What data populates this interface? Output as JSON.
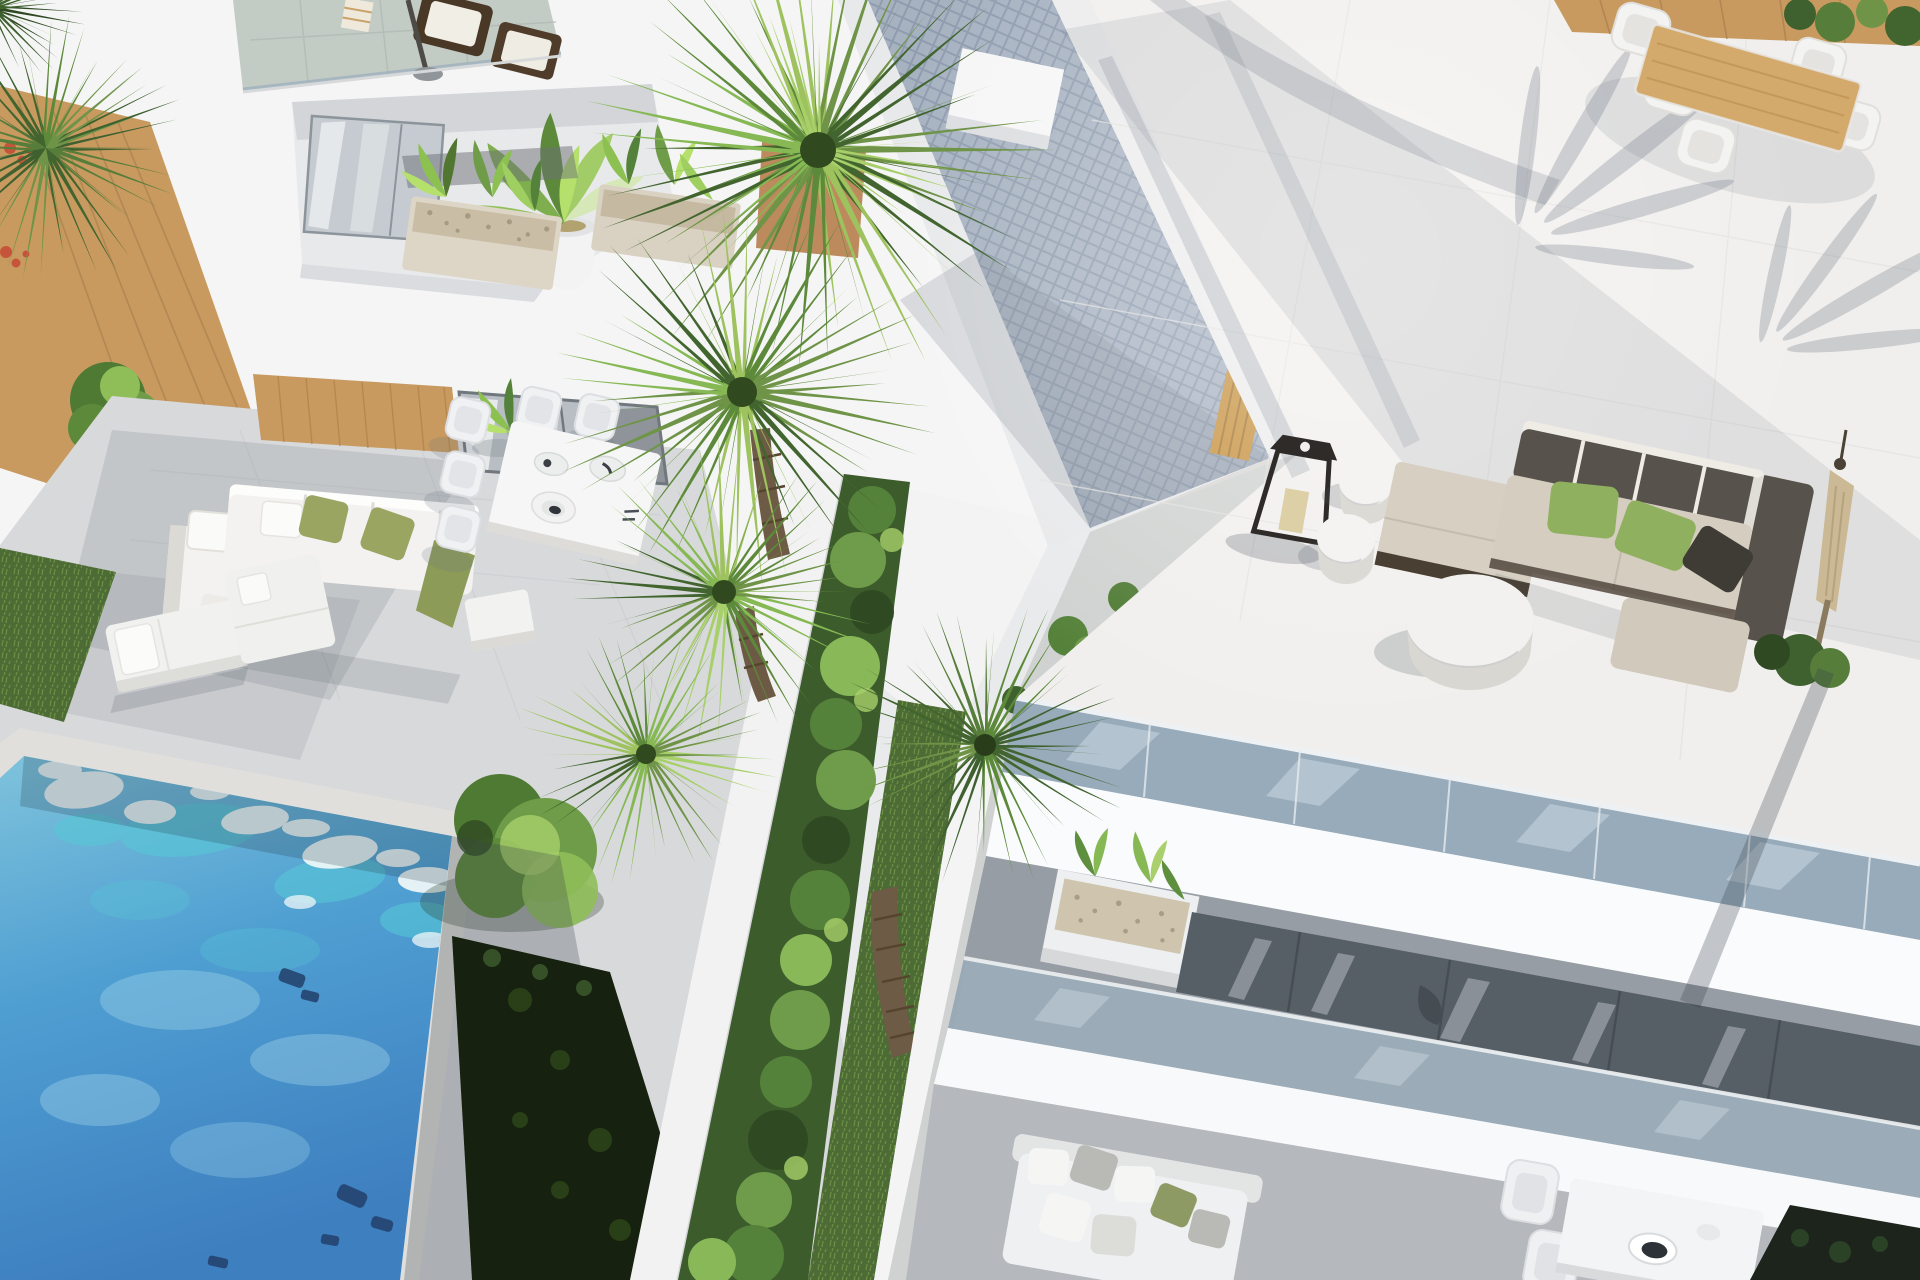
{
  "scene": {
    "title": "Aerial 3D architectural render of modern white villas with private pool, palm trees and roof terraces",
    "description": "Top-down rendering. Left: white villa with rooftop lounge, plant balconies, timber deck, garden patio with white corner sofa, dining set, sun loungers and a turquoise swimming pool. Center: fan palms over a hedge strip and a mosaic-tiled walkway. Right: second villa with large tiled roof terrace, taupe lounge set with green cushions, candle lantern, round tables, folded parasol, glass balustrades and a lower garden terrace.",
    "left_villa": {
      "label": "Villa A",
      "features": [
        "rooftop terrace with wicker armchairs and parasol",
        "balcony with potted plant",
        "stone planter balconies",
        "timber side deck with palms and red flowers",
        "patio with white corner sofa and olive pillows",
        "outdoor dining table with white chairs",
        "two sun loungers",
        "private turquoise pool"
      ]
    },
    "right_villa": {
      "label": "Villa B",
      "features": [
        "large roof terrace",
        "timber dining table with white wicker chairs",
        "taupe modular lounge sofa with green pillows",
        "black candle lantern",
        "white drum side tables",
        "round coffee table",
        "folded beige parasol",
        "glass balustrade edge",
        "lower terrace with planter, corner sofa and dining table"
      ]
    },
    "center": {
      "label": "Shared landscaping",
      "features": [
        "three fan palm trees",
        "clipped hedge strip",
        "lawn strips",
        "grey mosaic walkway",
        "timber gate"
      ]
    }
  },
  "palette": {
    "base_light": "#e9eaec",
    "white_wall": "#f5f5f6",
    "white_bright": "#fafbfc",
    "terrace_light": "#f1efed",
    "patio_tile": "#d8d9db",
    "rooftop_tile": "#c3cbc5",
    "pool_top": "#7fc3dc",
    "pool_deep": "#3e7fc0",
    "pool_turquoise": "#57c7d6",
    "pool_foam": "#edf6f7",
    "pool_dark_mark": "#23406b",
    "coping": "#e0dfdc",
    "grass": "#4c6b35",
    "grass_light": "#7d9a55",
    "hedge_dark": "#3c5c2c",
    "hedge_deep": "#16210f",
    "bush_light": "#8fbe59",
    "palm_light": "#9dc25e",
    "palm_mid": "#6f9447",
    "palm_dark": "#42652f",
    "trunk": "#6e5b45",
    "wood": "#c89a5f",
    "wood_table": "#d4aa6c",
    "gate_wood": "#c6913f",
    "mosaic": "#9aa6b6",
    "glass": "#8fa5b6",
    "glass2": "#92a5b3",
    "window_dark": "#565e66",
    "window_deep": "#1c241c",
    "recess": "#979da4",
    "lower_floor": "#b5b8bc",
    "sofa_white": "#f3f2f0",
    "cushion_olive": "#9aa562",
    "lounge_back": "#57524b",
    "lounge_beige": "#d6cfc2",
    "pillow_green": "#8fb05e",
    "lantern": "#2e2b28",
    "candle": "#ddcfa6",
    "shadow": "#5f6b7a"
  }
}
